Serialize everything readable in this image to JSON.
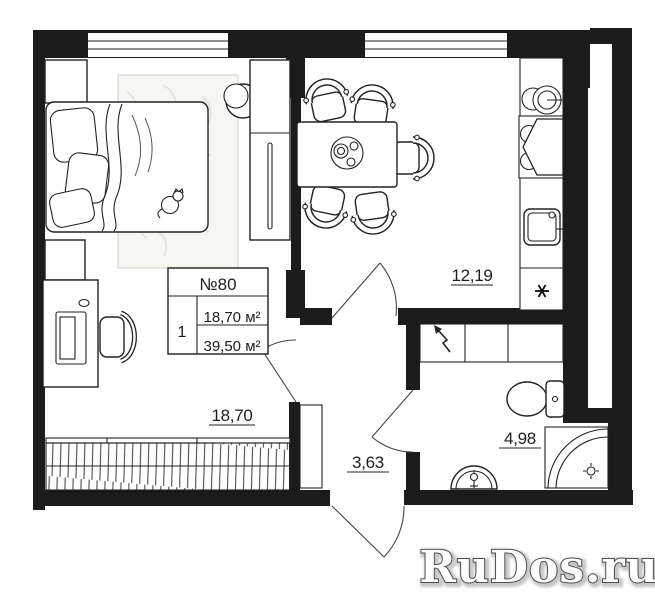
{
  "info_table": {
    "unit": "№80",
    "rooms_count": "1",
    "living_area": "18,70 м²",
    "total_area": "39,50 м²"
  },
  "room_labels": {
    "kitchen": "12,19",
    "bedroom": "18,70",
    "hall": "3,63",
    "bathroom": "4,98"
  },
  "watermark": "RuDos.ru",
  "icons": {
    "fridge": "snowflake-asterisk",
    "electric_panel": "lightning-arrow",
    "shower_drain": "circle-with-ticks",
    "window": "double-line-band"
  },
  "colors": {
    "wall": "#1b1b1b",
    "line": "#222222",
    "rug": "#f6f6f3",
    "watermark_fill": "#ffffff",
    "watermark_outline": "#4f4f4f"
  }
}
